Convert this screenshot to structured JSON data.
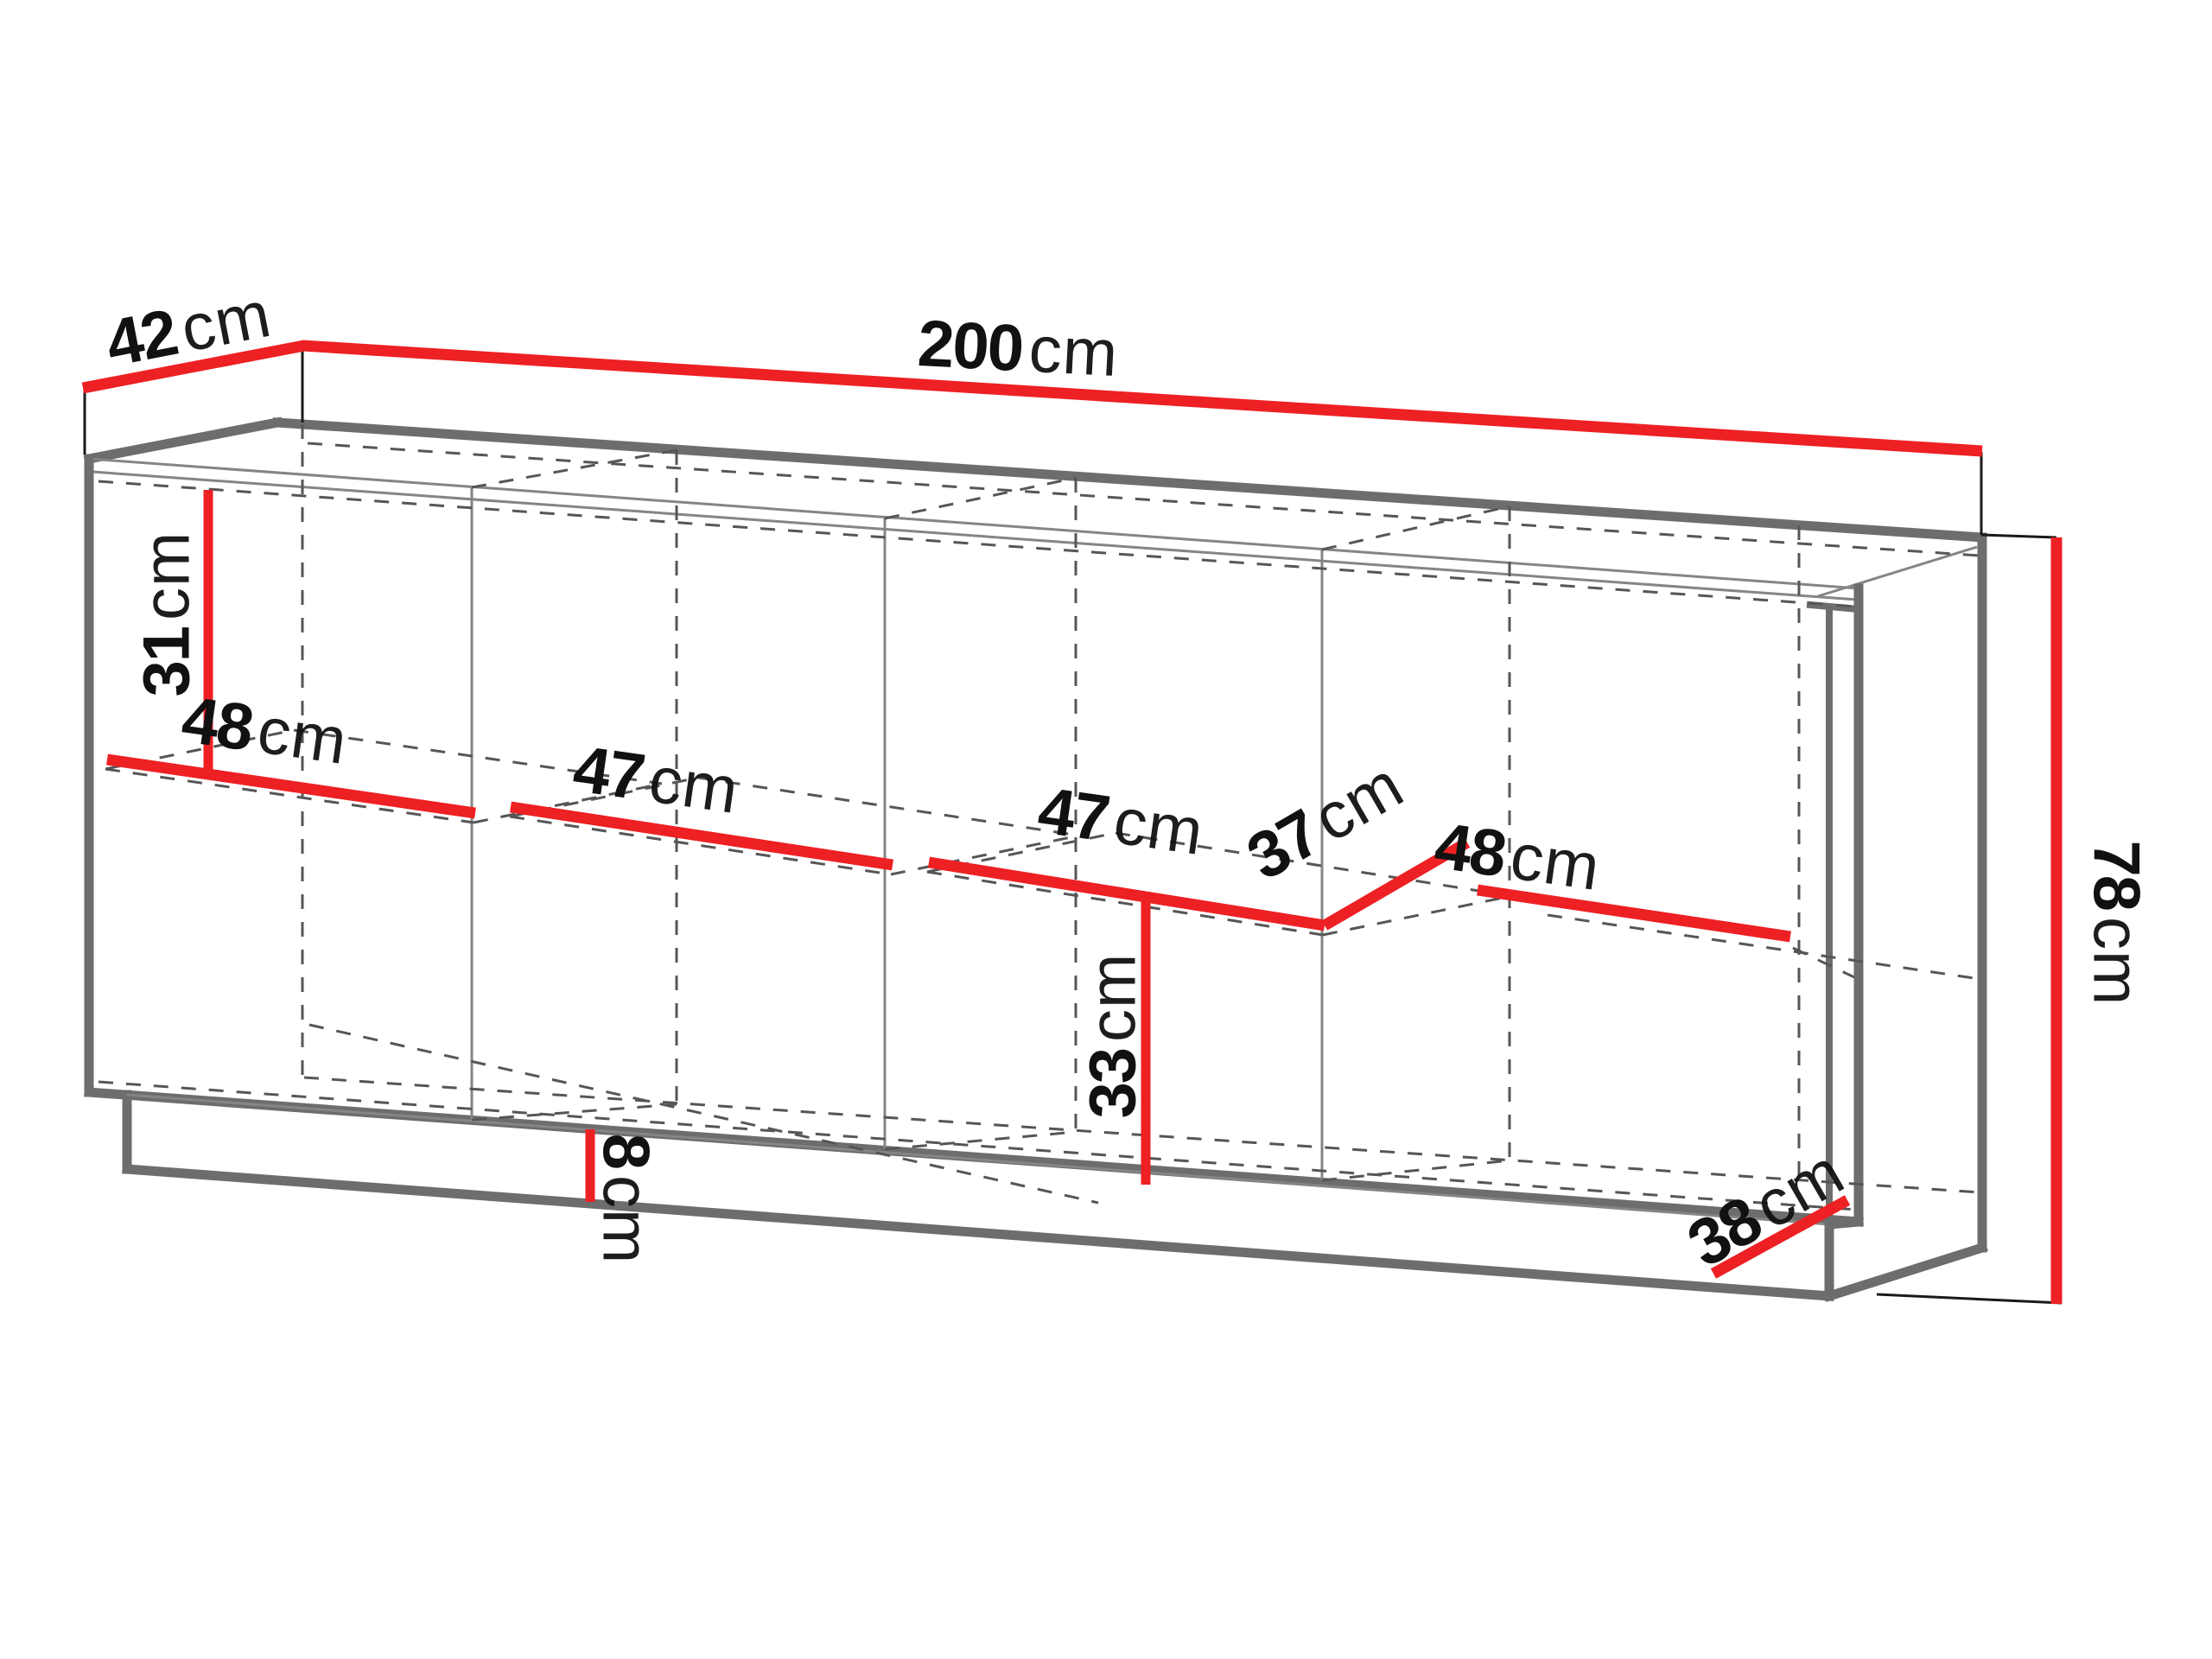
{
  "figure": {
    "type": "furniture-dimension-diagram",
    "subject": "sideboard-cabinet-wireframe"
  },
  "colors": {
    "dimension_red": "#ed2024",
    "outline_gray": "#6d6d6d",
    "thin_gray": "#858585",
    "dashed_gray": "#565656",
    "text_black": "#111111",
    "background": "#ffffff"
  },
  "dimensions": {
    "depth_top": {
      "value": "42",
      "unit": "cm"
    },
    "width_total": {
      "value": "200",
      "unit": "cm"
    },
    "height_total": {
      "value": "78",
      "unit": "cm"
    },
    "interior_upper_height": {
      "value": "31",
      "unit": "cm"
    },
    "shelf_section_1": {
      "value": "48",
      "unit": "cm"
    },
    "shelf_section_2": {
      "value": "47",
      "unit": "cm"
    },
    "shelf_section_3": {
      "value": "47",
      "unit": "cm"
    },
    "shelf_depth": {
      "value": "37",
      "unit": "cm"
    },
    "shelf_section_4": {
      "value": "48",
      "unit": "cm"
    },
    "interior_lower_height": {
      "value": "33",
      "unit": "cm"
    },
    "plinth_height": {
      "value": "8",
      "unit": "cm"
    },
    "base_depth": {
      "value": "38",
      "unit": "cm"
    }
  }
}
